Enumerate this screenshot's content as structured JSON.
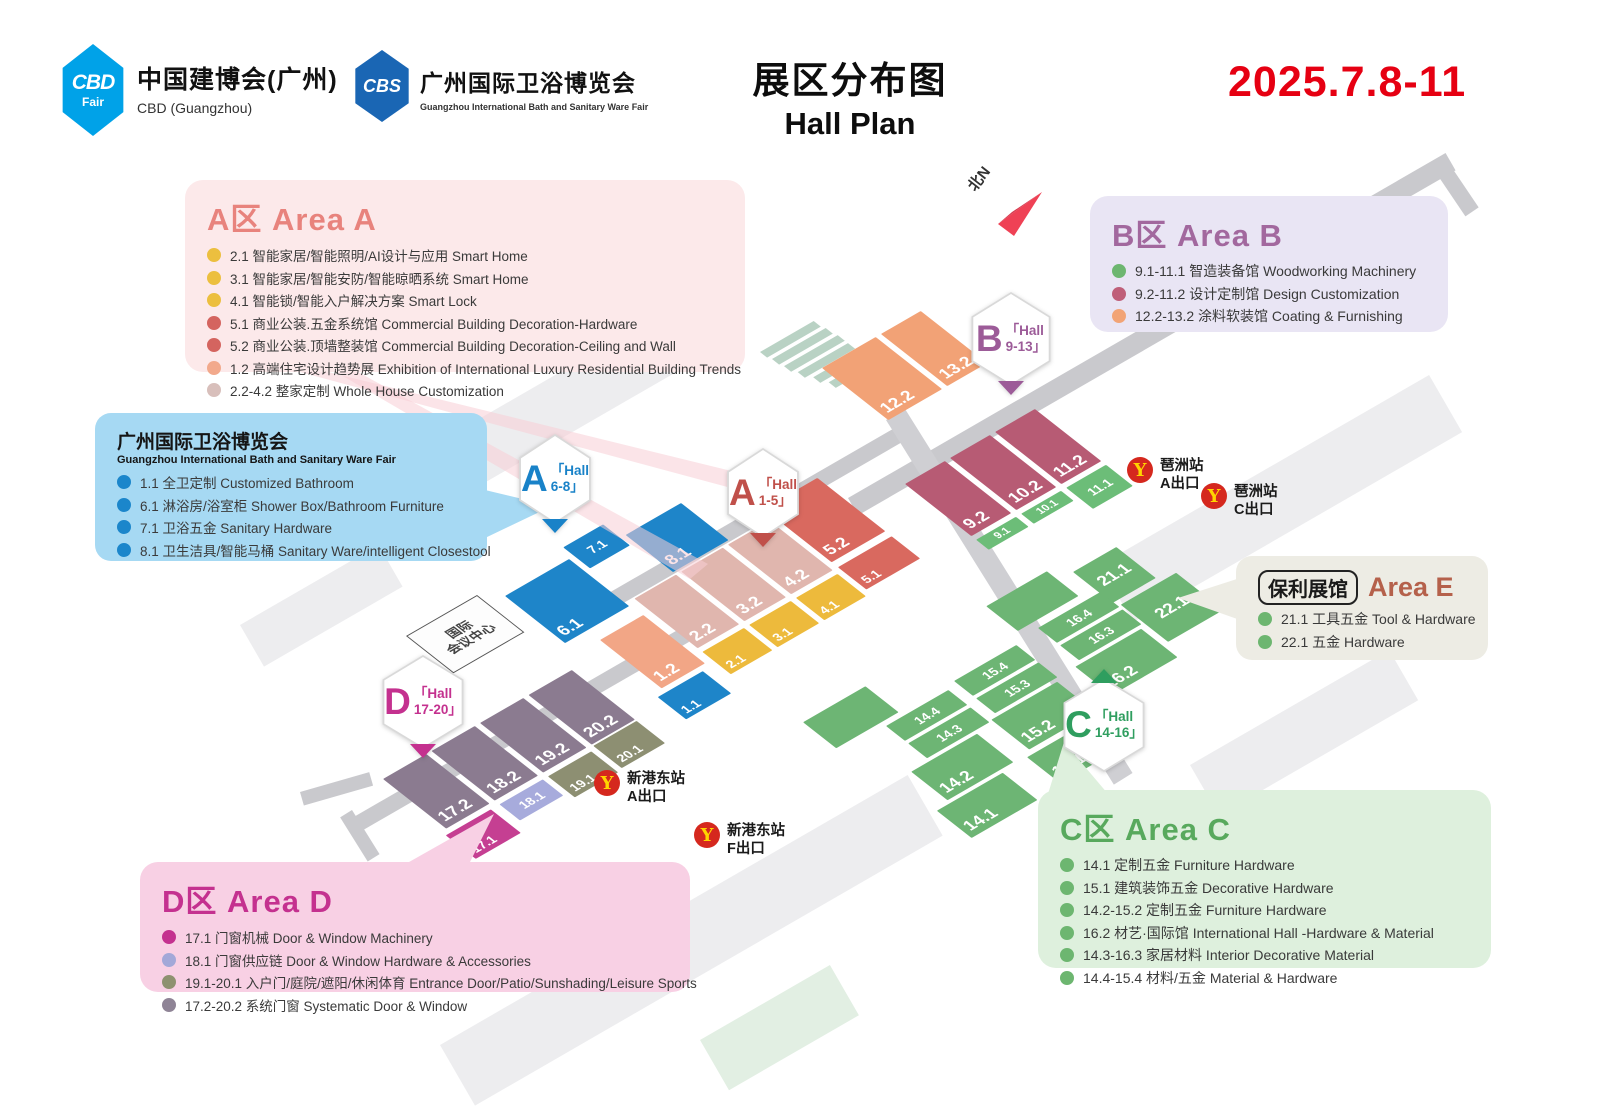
{
  "header": {
    "cbd_logo": {
      "text": "CBD",
      "sub": "Fair"
    },
    "cbd_title": "中国建博会(广州)",
    "cbd_subtitle": "CBD (Guangzhou)",
    "cbs_logo": {
      "text": "CBS"
    },
    "cbs_title": "广州国际卫浴博览会",
    "cbs_subtitle": "Guangzhou International Bath and Sanitary Ware Fair",
    "title_zh": "展区分布图",
    "title_en": "Hall Plan",
    "date": "2025.7.8-11"
  },
  "legends": {
    "area_a": {
      "title": "A区 Area A",
      "items": [
        {
          "dot": "#ecbf3f",
          "text": "2.1 智能家居/智能照明/AI设计与应用 Smart Home"
        },
        {
          "dot": "#ecbf3f",
          "text": "3.1 智能家居/智能安防/智能晾晒系统 Smart Home"
        },
        {
          "dot": "#ecbf3f",
          "text": "4.1 智能锁/智能入户解决方案 Smart Lock"
        },
        {
          "dot": "#d4645f",
          "text": "5.1 商业公装.五金系统馆 Commercial Building Decoration-Hardware"
        },
        {
          "dot": "#d4645f",
          "text": "5.2 商业公装.顶墙整装馆 Commercial Building Decoration-Ceiling and Wall"
        },
        {
          "dot": "#f2a98c",
          "text": "1.2 高端住宅设计趋势展 Exhibition of International Luxury Residential Building Trends"
        },
        {
          "dot": "#d8bfbb",
          "text": "2.2-4.2 整家定制 Whole House Customization"
        }
      ]
    },
    "bath": {
      "title": "广州国际卫浴博览会",
      "subtitle": "Guangzhou International Bath and Sanitary Ware Fair",
      "items": [
        {
          "dot": "#1b86cb",
          "text": "1.1 全卫定制 Customized Bathroom"
        },
        {
          "dot": "#1b86cb",
          "text": "6.1 淋浴房/浴室柜 Shower Box/Bathroom Furniture"
        },
        {
          "dot": "#1b86cb",
          "text": "7.1 卫浴五金 Sanitary Hardware"
        },
        {
          "dot": "#1b86cb",
          "text": "8.1 卫生洁具/智能马桶 Sanitary Ware/intelligent Closestool"
        }
      ]
    },
    "area_b": {
      "title": "B区 Area B",
      "items": [
        {
          "dot": "#6db670",
          "text": "9.1-11.1 智造装备馆 Woodworking Machinery"
        },
        {
          "dot": "#bf5f79",
          "text": "9.2-11.2 设计定制馆 Design Customization"
        },
        {
          "dot": "#f2a476",
          "text": "12.2-13.2 涂料软装馆 Coating & Furnishing"
        }
      ]
    },
    "area_e": {
      "title_box": "保利展馆",
      "title": "Area E",
      "items": [
        {
          "dot": "#6db670",
          "text": "21.1 工具五金 Tool & Hardware"
        },
        {
          "dot": "#6db670",
          "text": "22.1 五金 Hardware"
        }
      ]
    },
    "area_c": {
      "title": "C区 Area C",
      "items": [
        {
          "dot": "#6db670",
          "text": "14.1 定制五金 Furniture Hardware"
        },
        {
          "dot": "#6db670",
          "text": "15.1 建筑装饰五金 Decorative Hardware"
        },
        {
          "dot": "#6db670",
          "text": "14.2-15.2 定制五金 Furniture Hardware"
        },
        {
          "dot": "#6db670",
          "text": "16.2 材艺·国际馆 International Hall -Hardware & Material"
        },
        {
          "dot": "#6db670",
          "text": "14.3-16.3 家居材料 Interior Decorative Material"
        },
        {
          "dot": "#6db670",
          "text": "14.4-15.4 材料/五金 Material & Hardware"
        }
      ]
    },
    "area_d": {
      "title": "D区 Area D",
      "items": [
        {
          "dot": "#c4318f",
          "text": "17.1 门窗机械  Door & Window Machinery"
        },
        {
          "dot": "#a3a8d8",
          "text": "18.1 门窗供应链  Door & Window Hardware & Accessories"
        },
        {
          "dot": "#8e9170",
          "text": "19.1-20.1 入户门/庭院/遮阳/休闲体育 Entrance Door/Patio/Sunshading/Leisure Sports"
        },
        {
          "dot": "#8f8496",
          "text": "17.2-20.2 系统门窗 Systematic Door & Window"
        }
      ]
    }
  },
  "map": {
    "north": "北N",
    "building": {
      "line1": "国际",
      "line2": "会议中心"
    },
    "badges": {
      "a68": {
        "letter": "A",
        "line1": "「Hall",
        "line2": "6-8」"
      },
      "a15": {
        "letter": "A",
        "line1": "「Hall",
        "line2": "1-5」"
      },
      "b913": {
        "letter": "B",
        "line1": "「Hall",
        "line2": "9-13」"
      },
      "c1416": {
        "letter": "C",
        "line1": "「Hall",
        "line2": "14-16」"
      },
      "d1720": {
        "letter": "D",
        "line1": "「Hall",
        "line2": "17-20」"
      }
    },
    "stations": [
      {
        "name": "琶洲站",
        "exit": "A出口"
      },
      {
        "name": "琶洲站",
        "exit": "C出口"
      },
      {
        "name": "新港东站",
        "exit": "A出口"
      },
      {
        "name": "新港东站",
        "exit": "F出口"
      }
    ],
    "halls": {
      "h11": "1.1",
      "h12": "1.2",
      "h21": "2.1",
      "h22": "2.2",
      "h31": "3.1",
      "h32": "3.2",
      "h41": "4.1",
      "h42": "4.2",
      "h51": "5.1",
      "h52": "5.2",
      "h61": "6.1",
      "h71": "7.1",
      "h81": "8.1",
      "h91": "9.1",
      "h92": "9.2",
      "h101": "10.1",
      "h102": "10.2",
      "h111": "11.1",
      "h112": "11.2",
      "h122": "12.2",
      "h132": "13.2",
      "h141": "14.1",
      "h142": "14.2",
      "h143": "14.3",
      "h144": "14.4",
      "h151": "15.1",
      "h152": "15.2",
      "h153": "15.3",
      "h154": "15.4",
      "h162": "16.2",
      "h163": "16.3",
      "h164": "16.4",
      "h171": "17.1",
      "h172": "17.2",
      "h181": "18.1",
      "h182": "18.2",
      "h191": "19.1",
      "h192": "19.2",
      "h201": "20.1",
      "h202": "20.2",
      "h211": "21.1",
      "h221": "22.1"
    }
  },
  "colors": {
    "date_red": "#e60012",
    "metro_red": "#d5281e",
    "metro_yellow": "#ffd400",
    "area_a_title": "#e8837d",
    "area_b_title": "#a2689e",
    "area_c_title": "#58a95d",
    "area_d_title": "#c4318f",
    "area_e_title": "#b5614b",
    "hall_blue": "#1e85c9",
    "hall_yellow": "#edba3c",
    "hall_red": "#d9695f",
    "hall_palepink": "#e0b6ae",
    "hall_salmon": "#f2a686",
    "hall_orange": "#f2a276",
    "hall_mauve": "#b75b74",
    "hall_green": "#6db574",
    "hall_bgreen": "#6cbd78",
    "hall_dgray": "#8b7b90",
    "hall_magenta": "#c53f92",
    "hall_periwinkle": "#a7abdc",
    "hall_olive": "#8d8f72",
    "cbd_logo_blue": "#00a2e8",
    "cbs_logo_blue": "#1a66b4"
  }
}
